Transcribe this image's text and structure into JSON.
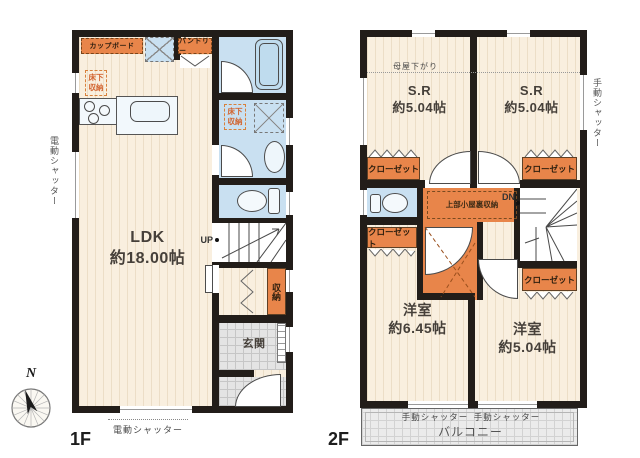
{
  "colors": {
    "wall": "#221d19",
    "floor_cream": "#f9efdf",
    "wet_blue": "#c9e0f1",
    "accent_orange": "#e8854a",
    "tile_gray": "#e4e4e4"
  },
  "compass": {
    "north_label": "N"
  },
  "floor1": {
    "floor_label": "1F",
    "ldk_name": "LDK",
    "ldk_size": "約18.00帖",
    "cupboard": "カップボード",
    "pantry": "パントリー",
    "floor_storage": "床下収納",
    "storage": "収納",
    "entrance": "玄関",
    "up": "UP",
    "electric_shutter": "電動シャッター"
  },
  "floor2": {
    "floor_label": "2F",
    "sr_name": "S.R",
    "sr_size": "約5.04帖",
    "room_left_name": "洋室",
    "room_left_size": "約6.45帖",
    "room_right_name": "洋室",
    "room_right_size": "約5.04帖",
    "closet": "クローゼット",
    "eaves_note": "母屋下がり",
    "attic_storage": "上部小屋裏収納",
    "dn": "DN",
    "manual_shutter": "手動シャッター",
    "balcony": "バルコニー"
  }
}
